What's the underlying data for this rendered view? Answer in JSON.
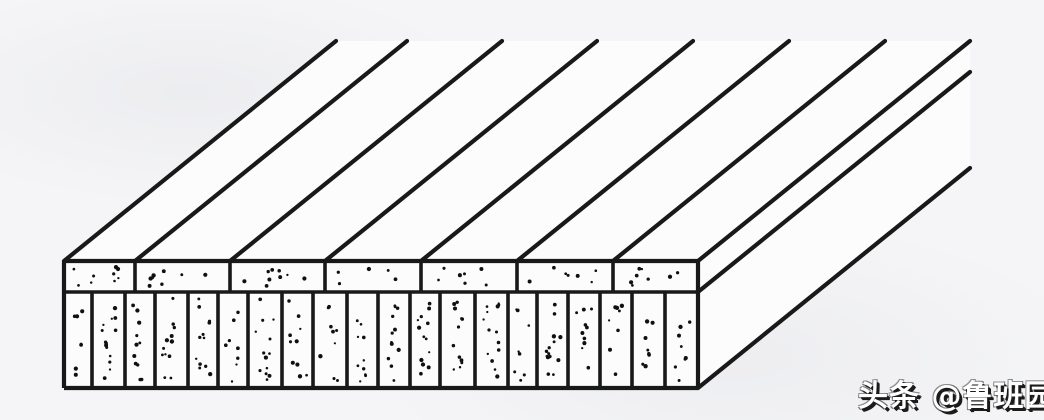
{
  "watermark": {
    "text": "头条 @鲁班园"
  },
  "diagram": {
    "name": "blockboard-panel-oblique-view",
    "canvas": {
      "width": 1044,
      "height": 420
    },
    "colors": {
      "paper": "#f5f5f7",
      "face": "#fcfcfd",
      "ink": "#191919",
      "dot": "#101010"
    },
    "front_face": {
      "left": 64,
      "right": 698,
      "top": 261,
      "layer_boundary": 292,
      "bottom": 388
    },
    "crossband_joints_x": [
      64,
      135,
      230,
      325,
      421,
      517,
      613,
      698
    ],
    "core_strip_boundaries_x": [
      64,
      92,
      125,
      155,
      188,
      218,
      248,
      282,
      313,
      347,
      378,
      410,
      440,
      475,
      508,
      537,
      568,
      600,
      632,
      665,
      698
    ],
    "depth_vector": {
      "dx": 272,
      "dy": -220
    },
    "side_edge_start_ys": [
      261,
      292,
      388
    ],
    "stroke": {
      "outer": 4.2,
      "inner": 3.6,
      "diagonal": 4.2
    },
    "stipple": {
      "seed": 20240731,
      "core_dots_min": 8,
      "core_dots_max": 14,
      "crossband_dots_min": 5,
      "crossband_dots_max": 9,
      "dot_r_min": 1.1,
      "dot_r_max": 2.2
    }
  }
}
